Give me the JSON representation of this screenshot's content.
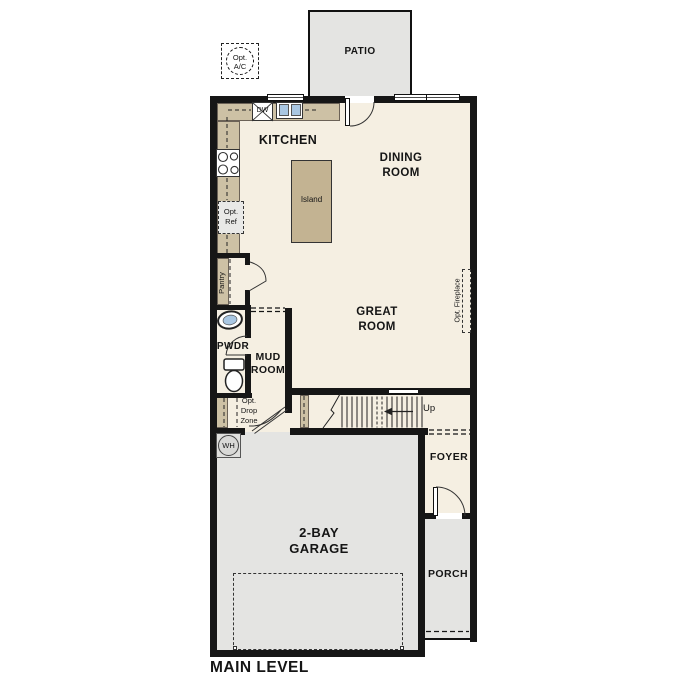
{
  "title": "MAIN LEVEL",
  "labels": {
    "patio": "PATIO",
    "opt_ac": "Opt.\nA/C",
    "kitchen": "KITCHEN",
    "dw": "DW",
    "dining_room": "DINING\nROOM",
    "great_room": "GREAT\nROOM",
    "island": "Island",
    "pantry": "Pantry",
    "opt_ref": "Opt.\nRef",
    "opt_fireplace": "Opt. Fireplace",
    "pwdr": "PWDR",
    "mud_room": "MUD\nROOM",
    "opt_drop_zone": "Opt.\nDrop\nZone",
    "wh": "WH",
    "up": "Up",
    "foyer": "FOYER",
    "garage": "2-BAY\nGARAGE",
    "porch": "PORCH",
    "main_level": "MAIN LEVEL"
  },
  "colors": {
    "floor": "#f5efe2",
    "counter": "#cdc1a5",
    "island": "#c3b392",
    "hardscape": "#e4e4e2",
    "wall": "#161616",
    "sink": "#a9c7e3"
  }
}
